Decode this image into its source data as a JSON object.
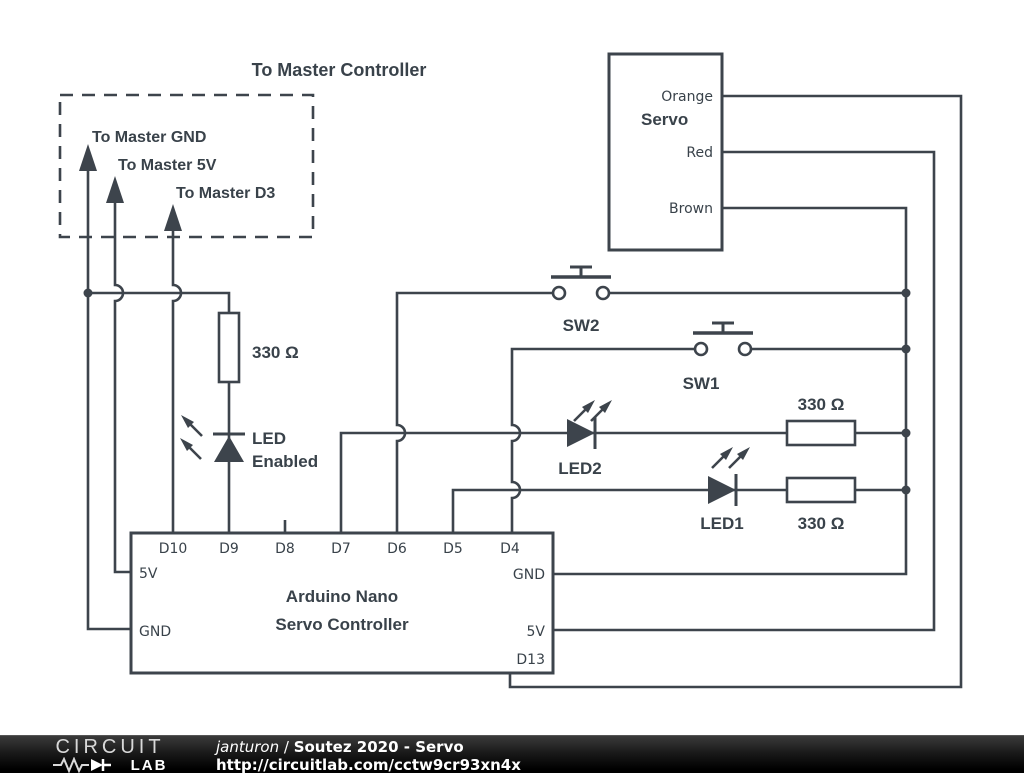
{
  "colors": {
    "wire": "#3d444c",
    "canvas": "#ffffff",
    "footer_background": "#000000",
    "footer_text": "#ffffff"
  },
  "master": {
    "title": "To Master Controller",
    "gnd": "To Master GND",
    "v5": "To Master 5V",
    "d3": "To Master D3"
  },
  "servo": {
    "name": "Servo",
    "wire_orange": "Orange",
    "wire_red": "Red",
    "wire_brown": "Brown"
  },
  "switches": {
    "sw2": "SW2",
    "sw1": "SW1"
  },
  "leds": {
    "led_enabled_line1": "LED",
    "led_enabled_line2": "Enabled",
    "led2": "LED2",
    "led1": "LED1"
  },
  "resistors": {
    "r_enabled": "330 Ω",
    "r_led2": "330 Ω",
    "r_led1": "330 Ω"
  },
  "arduino": {
    "name_line1": "Arduino Nano",
    "name_line2": "Servo Controller",
    "top_pins": [
      "D10",
      "D9",
      "D8",
      "D7",
      "D6",
      "D5",
      "D4"
    ],
    "left_pins": [
      "5V",
      "GND"
    ],
    "right_pins": [
      "GND",
      "5V",
      "D13"
    ]
  },
  "footer": {
    "logo_top": "CIRCUIT",
    "logo_bottom": "LAB",
    "author": "janturon",
    "separator": " / ",
    "project": "Soutez 2020 - Servo",
    "url": "http://circuitlab.com/cctw9cr93xn4x"
  }
}
